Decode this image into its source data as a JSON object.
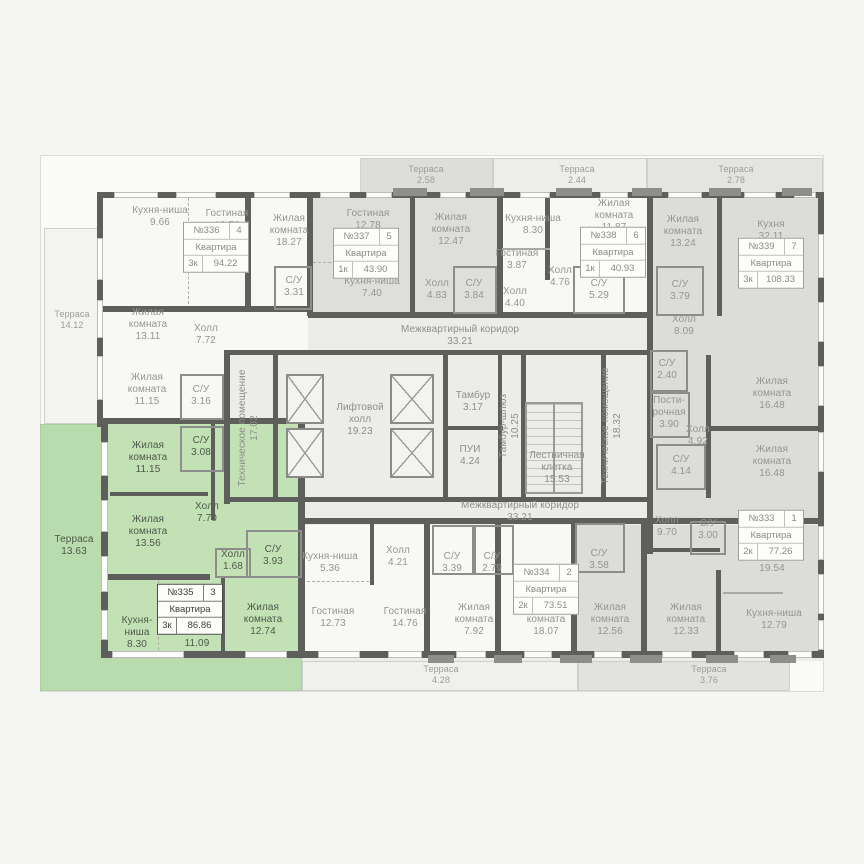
{
  "plan": {
    "colors": {
      "page_bg": "#f5f5f4",
      "corridor_fill": "#ececeb",
      "white_apartment": "#f8f8f7",
      "gray_apartment": "#dcdcdb",
      "selected_green": "#b8dcad",
      "selected_green_rooms": "#c2e2b5",
      "wall": "#5e5e5d",
      "label_text": "#96958f"
    },
    "regions": [
      {
        "id": "base",
        "x": 100,
        "y": 194,
        "w": 724,
        "h": 467,
        "fill": "#ececeb"
      },
      {
        "id": "terrace-left",
        "x": 44,
        "y": 228,
        "w": 56,
        "h": 196,
        "fill": "#f3f3f2",
        "cls": "bordered"
      },
      {
        "id": "terrace-top-1",
        "x": 360,
        "y": 158,
        "w": 133,
        "h": 38,
        "fill": "#dddddc",
        "cls": "bordered"
      },
      {
        "id": "terrace-top-2",
        "x": 493,
        "y": 158,
        "w": 154,
        "h": 38,
        "fill": "#eeeeed",
        "cls": "bordered"
      },
      {
        "id": "terrace-top-3",
        "x": 647,
        "y": 158,
        "w": 176,
        "h": 38,
        "fill": "#e4e4e3",
        "cls": "bordered"
      },
      {
        "id": "apartment-336",
        "x": 102,
        "y": 196,
        "w": 206,
        "h": 156,
        "fill": "#f8f8f7",
        "inter": true
      },
      {
        "id": "apartment-336-lower",
        "x": 102,
        "y": 352,
        "w": 122,
        "h": 72,
        "fill": "#f8f8f7",
        "inter": true
      },
      {
        "id": "apartment-337",
        "x": 312,
        "y": 196,
        "w": 188,
        "h": 118,
        "fill": "#dededd",
        "inter": true
      },
      {
        "id": "apartment-338",
        "x": 502,
        "y": 196,
        "w": 148,
        "h": 118,
        "fill": "#f8f8f7",
        "inter": true
      },
      {
        "id": "apartment-339",
        "x": 652,
        "y": 196,
        "w": 170,
        "h": 325,
        "fill": "#dcdcdb",
        "inter": true
      },
      {
        "id": "apartment-bottom-middle",
        "x": 305,
        "y": 525,
        "w": 270,
        "h": 132,
        "fill": "#f8f8f7",
        "inter": true
      },
      {
        "id": "apartment-333",
        "x": 577,
        "y": 525,
        "w": 245,
        "h": 132,
        "fill": "#dcdcdb",
        "inter": true
      },
      {
        "id": "terrace-bottom-1",
        "x": 302,
        "y": 661,
        "w": 276,
        "h": 30,
        "fill": "#f0f0ef",
        "cls": "bordered"
      },
      {
        "id": "terrace-bottom-2",
        "x": 578,
        "y": 661,
        "w": 212,
        "h": 30,
        "fill": "#e2e2e1",
        "cls": "bordered"
      },
      {
        "id": "apartment-335-terrace",
        "x": 40,
        "y": 424,
        "w": 262,
        "h": 267,
        "fill": "#b8dcad",
        "cls": "greenb",
        "inter": true
      },
      {
        "id": "apartment-335-rooms",
        "x": 107,
        "y": 424,
        "w": 195,
        "h": 233,
        "fill": "#c2e2b5",
        "inter": true
      }
    ],
    "walls": [
      [
        100,
        192,
        724,
        6
      ],
      [
        97,
        192,
        6,
        235
      ],
      [
        101,
        424,
        7,
        234
      ],
      [
        101,
        651,
        204,
        7
      ],
      [
        298,
        651,
        526,
        7
      ],
      [
        818,
        192,
        6,
        466
      ],
      [
        307,
        196,
        6,
        120
      ],
      [
        497,
        196,
        6,
        120
      ],
      [
        647,
        196,
        6,
        329
      ],
      [
        308,
        312,
        345,
        6
      ],
      [
        100,
        306,
        213,
        6
      ],
      [
        100,
        418,
        207,
        6
      ],
      [
        298,
        424,
        7,
        230
      ],
      [
        224,
        350,
        6,
        154
      ],
      [
        224,
        350,
        428,
        5
      ],
      [
        224,
        497,
        428,
        5
      ],
      [
        300,
        518,
        524,
        6
      ],
      [
        424,
        523,
        6,
        130
      ],
      [
        495,
        523,
        6,
        130
      ],
      [
        571,
        518,
        6,
        135
      ],
      [
        641,
        523,
        6,
        130
      ],
      [
        245,
        196,
        6,
        112
      ],
      [
        410,
        196,
        5,
        118
      ],
      [
        545,
        196,
        5,
        84
      ],
      [
        717,
        196,
        5,
        120
      ],
      [
        706,
        355,
        5,
        143
      ],
      [
        706,
        426,
        114,
        5
      ],
      [
        443,
        352,
        5,
        147
      ],
      [
        498,
        355,
        4,
        144
      ],
      [
        521,
        352,
        5,
        147
      ],
      [
        601,
        352,
        5,
        147
      ],
      [
        443,
        426,
        60,
        4
      ],
      [
        273,
        352,
        5,
        147
      ],
      [
        650,
        548,
        70,
        4
      ],
      [
        716,
        570,
        5,
        85
      ],
      [
        647,
        518,
        6,
        36
      ],
      [
        211,
        424,
        4,
        96
      ],
      [
        110,
        492,
        98,
        4
      ],
      [
        108,
        574,
        102,
        6
      ],
      [
        221,
        578,
        4,
        74
      ],
      [
        370,
        523,
        4,
        62
      ],
      [
        723,
        592,
        60,
        2,
        "thin"
      ],
      [
        502,
        248,
        48,
        2,
        "thin"
      ],
      [
        188,
        198,
        1,
        106,
        "dashv"
      ],
      [
        313,
        262,
        84,
        1,
        "dashh"
      ],
      [
        158,
        580,
        1,
        70,
        "dashv"
      ],
      [
        307,
        581,
        62,
        1,
        "dashh"
      ]
    ],
    "boxes": [
      [
        274,
        266,
        38,
        44
      ],
      [
        180,
        374,
        44,
        46
      ],
      [
        453,
        266,
        44,
        48
      ],
      [
        573,
        266,
        52,
        48
      ],
      [
        656,
        266,
        48,
        50
      ],
      [
        650,
        350,
        38,
        42
      ],
      [
        650,
        392,
        40,
        46
      ],
      [
        656,
        444,
        50,
        46
      ],
      [
        180,
        426,
        44,
        46
      ],
      [
        246,
        530,
        56,
        48
      ],
      [
        432,
        525,
        42,
        50
      ],
      [
        474,
        525,
        40,
        50
      ],
      [
        575,
        523,
        50,
        50
      ],
      [
        690,
        521,
        36,
        34
      ],
      [
        215,
        548,
        36,
        30
      ]
    ],
    "windows": [
      [
        114,
        192,
        44,
        6
      ],
      [
        176,
        192,
        40,
        6
      ],
      [
        254,
        192,
        36,
        6
      ],
      [
        320,
        192,
        30,
        6
      ],
      [
        366,
        192,
        26,
        6
      ],
      [
        440,
        192,
        26,
        6
      ],
      [
        520,
        192,
        30,
        6
      ],
      [
        600,
        192,
        28,
        6
      ],
      [
        668,
        192,
        34,
        6
      ],
      [
        744,
        192,
        32,
        6
      ],
      [
        794,
        192,
        22,
        6
      ],
      [
        97,
        238,
        6,
        42
      ],
      [
        97,
        300,
        6,
        38
      ],
      [
        97,
        356,
        6,
        44
      ],
      [
        101,
        442,
        7,
        34
      ],
      [
        101,
        500,
        7,
        32
      ],
      [
        101,
        556,
        7,
        36
      ],
      [
        101,
        610,
        7,
        30
      ],
      [
        112,
        651,
        72,
        7
      ],
      [
        245,
        651,
        42,
        7
      ],
      [
        318,
        651,
        42,
        7
      ],
      [
        388,
        651,
        34,
        7
      ],
      [
        456,
        651,
        30,
        7
      ],
      [
        524,
        651,
        28,
        7
      ],
      [
        594,
        651,
        28,
        7
      ],
      [
        662,
        651,
        30,
        7
      ],
      [
        734,
        651,
        30,
        7
      ],
      [
        788,
        651,
        24,
        7
      ],
      [
        818,
        234,
        6,
        44
      ],
      [
        818,
        302,
        6,
        40
      ],
      [
        818,
        366,
        6,
        40
      ],
      [
        818,
        432,
        6,
        40
      ],
      [
        818,
        526,
        6,
        34
      ],
      [
        818,
        574,
        6,
        40
      ],
      [
        818,
        620,
        6,
        30
      ]
    ],
    "posts": [
      [
        393,
        188,
        34,
        8
      ],
      [
        470,
        188,
        34,
        8
      ],
      [
        556,
        188,
        36,
        8
      ],
      [
        632,
        188,
        30,
        8
      ],
      [
        709,
        188,
        32,
        8
      ],
      [
        782,
        188,
        30,
        8
      ],
      [
        428,
        655,
        26,
        8
      ],
      [
        494,
        655,
        28,
        8
      ],
      [
        560,
        655,
        32,
        8
      ],
      [
        630,
        655,
        32,
        8
      ],
      [
        706,
        655,
        32,
        8
      ],
      [
        770,
        655,
        26,
        8
      ]
    ],
    "elevators": [
      [
        286,
        374,
        38,
        50
      ],
      [
        286,
        428,
        38,
        50
      ],
      [
        390,
        374,
        44,
        50
      ],
      [
        390,
        428,
        44,
        50
      ]
    ],
    "stairs": [
      525,
      402,
      58,
      92
    ],
    "rooms": [
      {
        "n": "Кухня-ниша",
        "a": "9.66",
        "x": 160,
        "y": 217
      },
      {
        "n": "Гостиная",
        "a": "13.72",
        "x": 227,
        "y": 220
      },
      {
        "n": "Жилая\nкомната",
        "a": "18.27",
        "x": 289,
        "y": 231
      },
      {
        "n": "С/У",
        "a": "3.31",
        "x": 294,
        "y": 287
      },
      {
        "n": "Жилая\nкомната",
        "a": "13.11",
        "x": 148,
        "y": 325
      },
      {
        "n": "Холл",
        "a": "7.72",
        "x": 206,
        "y": 335
      },
      {
        "n": "Терраса",
        "a": "14.12",
        "x": 72,
        "y": 320,
        "c": "ter"
      },
      {
        "n": "Жилая\nкомната",
        "a": "11.15",
        "x": 147,
        "y": 390
      },
      {
        "n": "С/У",
        "a": "3.16",
        "x": 201,
        "y": 396
      },
      {
        "n": "Гостиная",
        "a": "12.78",
        "x": 368,
        "y": 220
      },
      {
        "n": "Кухня-ниша",
        "a": "7.40",
        "x": 372,
        "y": 288
      },
      {
        "n": "Жилая\nкомната",
        "a": "12.47",
        "x": 451,
        "y": 230
      },
      {
        "n": "Холл",
        "a": "4.83",
        "x": 437,
        "y": 290
      },
      {
        "n": "С/У",
        "a": "3.84",
        "x": 474,
        "y": 290
      },
      {
        "n": "Кухня-ниша",
        "a": "8.30",
        "x": 533,
        "y": 225
      },
      {
        "n": "Жилая\nкомната",
        "a": "11.87",
        "x": 614,
        "y": 216
      },
      {
        "n": "Гостиная",
        "a": "3.87",
        "x": 517,
        "y": 260
      },
      {
        "n": "Холл",
        "a": "4.76",
        "x": 560,
        "y": 277
      },
      {
        "n": "Холл",
        "a": "4.40",
        "x": 515,
        "y": 298
      },
      {
        "n": "С/У",
        "a": "5.29",
        "x": 599,
        "y": 290
      },
      {
        "n": "Жилая\nкомната",
        "a": "13.24",
        "x": 683,
        "y": 232
      },
      {
        "n": "Кухня",
        "a": "32.11",
        "x": 771,
        "y": 231
      },
      {
        "n": "С/У",
        "a": "3.79",
        "x": 680,
        "y": 291
      },
      {
        "n": "Холл",
        "a": "8.09",
        "x": 684,
        "y": 326
      },
      {
        "n": "Терраса",
        "a": "2.58",
        "x": 426,
        "y": 175,
        "c": "ter"
      },
      {
        "n": "Терраса",
        "a": "2.44",
        "x": 577,
        "y": 175,
        "c": "ter"
      },
      {
        "n": "Терраса",
        "a": "2.78",
        "x": 736,
        "y": 175,
        "c": "ter"
      },
      {
        "n": "Межквартирный коридор",
        "a": "33.21",
        "x": 460,
        "y": 336,
        "c": "cor"
      },
      {
        "n": "Техническое помещение",
        "a": "17.02",
        "x": 249,
        "y": 428,
        "v": true,
        "c": "cor"
      },
      {
        "n": "Лифтовой\nхолл",
        "a": "19.23",
        "x": 360,
        "y": 420,
        "c": "cor"
      },
      {
        "n": "Тамбур",
        "a": "3.17",
        "x": 473,
        "y": 402,
        "c": "cor"
      },
      {
        "n": "ПУИ",
        "a": "4.24",
        "x": 470,
        "y": 456,
        "c": "cor"
      },
      {
        "n": "Тамбур-шлюз",
        "a": "10.25",
        "x": 510,
        "y": 426,
        "v": true,
        "c": "cor"
      },
      {
        "n": "Лестничная\nклетка",
        "a": "15.53",
        "x": 557,
        "y": 468,
        "c": "cor"
      },
      {
        "n": "Техническое помещение",
        "a": "18.32",
        "x": 612,
        "y": 426,
        "v": true,
        "c": "cor"
      },
      {
        "n": "Межквартирный коридор",
        "a": "33.21",
        "x": 520,
        "y": 512,
        "c": "cor"
      },
      {
        "n": "С/У",
        "a": "2.40",
        "x": 667,
        "y": 370
      },
      {
        "n": "Пости-\nрочная",
        "a": "3.90",
        "x": 669,
        "y": 413
      },
      {
        "n": "Холл",
        "a": "4.92",
        "x": 698,
        "y": 436
      },
      {
        "n": "С/У",
        "a": "4.14",
        "x": 681,
        "y": 466
      },
      {
        "n": "Жилая\nкомната",
        "a": "16.48",
        "x": 772,
        "y": 394
      },
      {
        "n": "Жилая\nкомната",
        "a": "16.48",
        "x": 772,
        "y": 462
      },
      {
        "n": "Терраса",
        "a": "13.63",
        "x": 74,
        "y": 546,
        "c": "grn"
      },
      {
        "n": "Жилая\nкомната",
        "a": "11.15",
        "x": 148,
        "y": 458,
        "c": "grn"
      },
      {
        "n": "С/У",
        "a": "3.08",
        "x": 201,
        "y": 447,
        "c": "grn"
      },
      {
        "n": "Холл",
        "a": "7.70",
        "x": 207,
        "y": 513,
        "c": "grn"
      },
      {
        "n": "Жилая\nкомната",
        "a": "13.56",
        "x": 148,
        "y": 532,
        "c": "grn"
      },
      {
        "n": "Холл",
        "a": "1.68",
        "x": 233,
        "y": 561,
        "c": "grn"
      },
      {
        "n": "С/У",
        "a": "3.93",
        "x": 273,
        "y": 556,
        "c": "grn"
      },
      {
        "n": "Кухня-\nниша",
        "a": "8.30",
        "x": 137,
        "y": 633,
        "c": "grn"
      },
      {
        "n": "Гостиная",
        "a": "11.09",
        "x": 197,
        "y": 638,
        "c": "grn"
      },
      {
        "n": "Жилая\nкомната",
        "a": "12.74",
        "x": 263,
        "y": 620,
        "c": "grn"
      },
      {
        "n": "Кухня-ниша",
        "a": "5.36",
        "x": 330,
        "y": 563
      },
      {
        "n": "Холл",
        "a": "4.21",
        "x": 398,
        "y": 557
      },
      {
        "n": "С/У",
        "a": "3.39",
        "x": 452,
        "y": 563
      },
      {
        "n": "С/У",
        "a": "2.79",
        "x": 492,
        "y": 563
      },
      {
        "n": "Гостиная",
        "a": "12.73",
        "x": 333,
        "y": 618
      },
      {
        "n": "Гостиная",
        "a": "14.76",
        "x": 405,
        "y": 618
      },
      {
        "n": "Жилая\nкомната",
        "a": "7.92",
        "x": 474,
        "y": 620
      },
      {
        "n": "С/У",
        "a": "3.58",
        "x": 599,
        "y": 560
      },
      {
        "n": "Жилая\nкомната",
        "a": "18.07",
        "x": 546,
        "y": 620
      },
      {
        "n": "Жилая\nкомната",
        "a": "12.56",
        "x": 610,
        "y": 620
      },
      {
        "n": "Холл",
        "a": "9.70",
        "x": 667,
        "y": 527
      },
      {
        "n": "С/У",
        "a": "3.00",
        "x": 708,
        "y": 530
      },
      {
        "n": "Гостиная",
        "a": "19.54",
        "x": 772,
        "y": 563
      },
      {
        "n": "Кухня-ниша",
        "a": "12.79",
        "x": 774,
        "y": 620
      },
      {
        "n": "Жилая\nкомната",
        "a": "12.33",
        "x": 686,
        "y": 620
      },
      {
        "n": "Терраса",
        "a": "4.28",
        "x": 441,
        "y": 675,
        "c": "ter"
      },
      {
        "n": "Терраса",
        "a": "3.76",
        "x": 709,
        "y": 675,
        "c": "ter"
      }
    ],
    "tags": [
      {
        "num": "№336",
        "pos": "4",
        "t": "Квартира",
        "k": "3к",
        "area": "94.22",
        "x": 216,
        "y": 247
      },
      {
        "num": "№337",
        "pos": "5",
        "t": "Квартира",
        "k": "1к",
        "area": "43.90",
        "x": 366,
        "y": 253
      },
      {
        "num": "№338",
        "pos": "6",
        "t": "Квартира",
        "k": "1к",
        "area": "40.93",
        "x": 613,
        "y": 252
      },
      {
        "num": "№339",
        "pos": "7",
        "t": "Квартира",
        "k": "3к",
        "area": "108.33",
        "x": 771,
        "y": 263
      },
      {
        "num": "№335",
        "pos": "3",
        "t": "Квартира",
        "k": "3к",
        "area": "86.86",
        "x": 190,
        "y": 609,
        "sel": true
      },
      {
        "num": "№334",
        "pos": "2",
        "t": "Квартира",
        "k": "2к",
        "area": "73.51",
        "x": 546,
        "y": 589
      },
      {
        "num": "№333",
        "pos": "1",
        "t": "Квартира",
        "k": "2к",
        "area": "77.26",
        "x": 771,
        "y": 535
      }
    ]
  }
}
